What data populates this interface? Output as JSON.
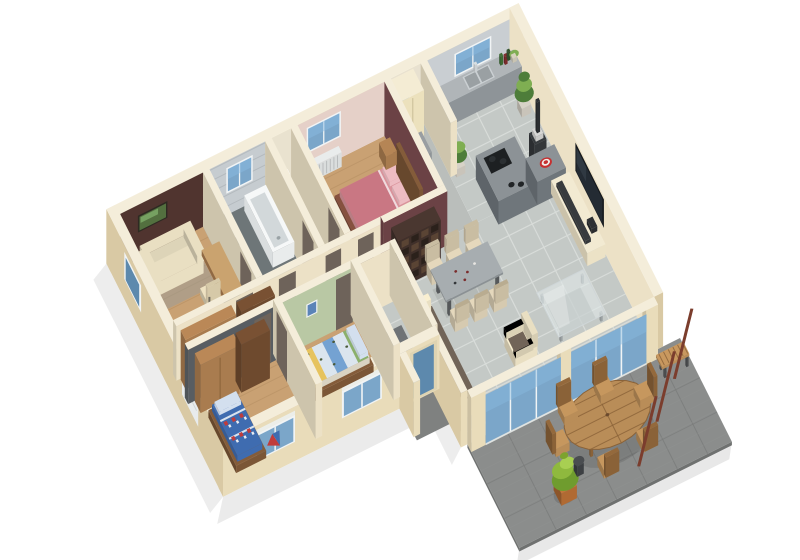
{
  "meta": {
    "title": "3D cutaway floor plan of a single-storey house with terrace",
    "view": "axonometric dollhouse render, white background"
  },
  "palette": {
    "bg": "#ffffff",
    "wall_top": "#f4edda",
    "wall_ext": "#e9dcba",
    "wall_ext_shade": "#d9c9a4",
    "wall_int": "#ece1c6",
    "maroon": "#6b4245",
    "office_wall": "#50342f",
    "kid1_wall": "#585d62",
    "kid2_wall": "#b9c8a4",
    "bath_wall": "#c6ccd0",
    "master_wall": "#e5d0c8",
    "wc_wall": "#e9e2cf",
    "storage_wall": "#e8e1d0",
    "kitchen_wall": "#c9ced2",
    "wood": "#c9a173",
    "wood_line": "#b08a5e",
    "bath_floor": "#6e7678",
    "wc_floor": "#d3c9b2",
    "storage_floor": "#babebb",
    "tile": "#c4c9c6",
    "tile_line": "#d8dcd9",
    "patio": "#8b8d8c",
    "patio_line": "#7a7c7b",
    "patio_edge": "#6f7170",
    "porch": "#7f8180",
    "glass": "#7ba6c9",
    "glass_dark": "#5d89ad",
    "frame": "#f1f4f5",
    "door": "#6e635a",
    "sofa_cream": "#e9dfc2",
    "cushion": "#716458",
    "bed_pink": "#d9939b",
    "duvet": "#c97783",
    "pillow": "#edbcc2",
    "bed_frame": "#7d4c3b",
    "wood_furn": "#a97c4f",
    "wood_dark": "#7b5636",
    "shelf": "#40302a",
    "kid_blue": "#3f6cb0",
    "kid_red": "#c03c3c",
    "kid_pillow": "#d3dfee",
    "k2_yellow": "#e6c35e",
    "k2_blue": "#74a2d2",
    "k2_green": "#8bb06c",
    "counter": "#8e9498",
    "counter_top": "#b0b5b8",
    "island": "#6f767b",
    "island_top": "#8c9296",
    "steel": "#cbd0d3",
    "dark": "#26292c",
    "tv": "#14171b",
    "tv_screen": "#242b33",
    "console": "#ece2c6",
    "soundbar": "#34373a",
    "plant": "#4e7d3a",
    "plant_light": "#7fae52",
    "pot": "#b06a33",
    "red": "#c63030",
    "radiator": "#dadddd",
    "white": "#f6f7f7",
    "stool": "#3d4043",
    "post": "#7b3d2d",
    "patio_wood": "#b98d58",
    "patio_wood_dark": "#8a6238"
  },
  "rooms": [
    {
      "id": "office",
      "name": "Office / study",
      "floor": "wood",
      "accent": "dark brown wall",
      "items": [
        "cream sofa",
        "desk",
        "desk chair",
        "green landscape picture"
      ]
    },
    {
      "id": "bathroom",
      "name": "Bathroom",
      "floor": "dark tile",
      "accent": "grey tiled walls",
      "items": [
        "bathtub",
        "double washbasin counter",
        "window"
      ]
    },
    {
      "id": "wc",
      "name": "WC",
      "floor": "beige",
      "items": [
        "toilet"
      ]
    },
    {
      "id": "master-bedroom",
      "name": "Master bedroom",
      "floor": "wood",
      "accent": "burgundy wall",
      "items": [
        "double bed with pink duvet",
        "two pillows",
        "wood headboard",
        "nightstands",
        "bed-end bench",
        "radiator",
        "window"
      ]
    },
    {
      "id": "storage",
      "name": "Storage / utility room",
      "floor": "grey",
      "items": [
        "tall beige cabinet",
        "low grey cabinet",
        "window"
      ]
    },
    {
      "id": "kitchen",
      "name": "Kitchen",
      "floor": "grey tile",
      "items": [
        "worktop with double sink",
        "window",
        "bottles",
        "island with hob",
        "red bowl",
        "pellet stove with flue",
        "green plants"
      ]
    },
    {
      "id": "hallway",
      "name": "Hallway",
      "floor": "wood",
      "items": [
        "built-in wardrobes"
      ]
    },
    {
      "id": "kids-bedroom-1",
      "name": "Children's bedroom 1",
      "floor": "wood",
      "accent": "dark grey wall",
      "items": [
        "bed with blue character duvet",
        "two brown wardrobes",
        "play flag",
        "radiator",
        "window"
      ]
    },
    {
      "id": "kids-bedroom-2",
      "name": "Children's bedroom 2",
      "floor": "wood",
      "accent": "light green wall",
      "items": [
        "bed with striped duvet",
        "small wall picture",
        "radiator",
        "window"
      ]
    },
    {
      "id": "entrance",
      "name": "Entrance",
      "floor": "grey tile",
      "items": [
        "glazed front door",
        "doormat",
        "porch paving"
      ]
    },
    {
      "id": "living-dining",
      "name": "Living / dining room",
      "floor": "grey tile",
      "items": [
        "dining table",
        "six chairs",
        "wine glasses",
        "sofa with dark cushions",
        "white mug",
        "armchair",
        "glass coffee table",
        "wall-mounted TV",
        "cream TV console",
        "dark cubby bookshelf"
      ]
    },
    {
      "id": "terrace",
      "name": "Terrace",
      "floor": "dark grey pavers",
      "items": [
        "oval slatted wood table",
        "six wooden chairs",
        "wooden bench",
        "leaning pergola posts",
        "potted green plant",
        "dark side stool"
      ]
    }
  ],
  "exterior": {
    "walls": "cream render, cut-away tops",
    "openings": [
      "left wall window",
      "left wall shutter",
      "two front bedroom windows with roller shutters",
      "glazed entrance door",
      "two large sliding glass bays to terrace"
    ]
  }
}
